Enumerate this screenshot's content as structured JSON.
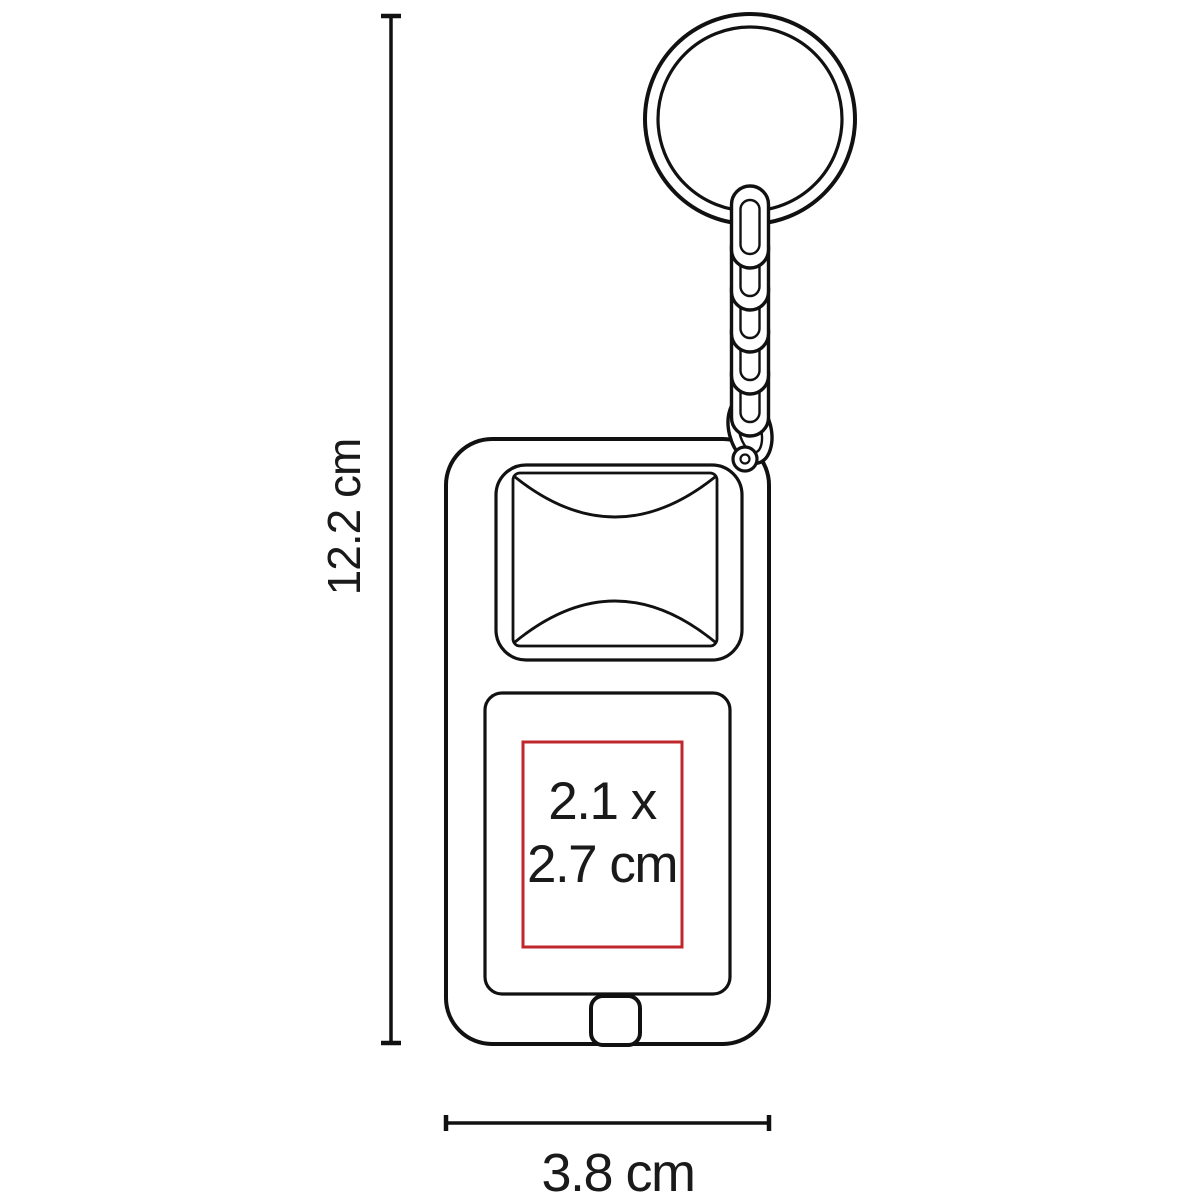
{
  "diagram": {
    "height_label": "12.2 cm",
    "width_label": "3.8 cm",
    "print_area_label": {
      "line1": "2.1 x",
      "line2": "2.7 cm"
    },
    "dimensions": {
      "height_cm": 12.2,
      "width_cm": 3.8,
      "print_width_cm": 2.1,
      "print_height_cm": 2.7
    },
    "colors": {
      "background": "#ffffff",
      "outline": "#111111",
      "text": "#1a1a1a",
      "print_area_border": "#c0272d"
    }
  }
}
